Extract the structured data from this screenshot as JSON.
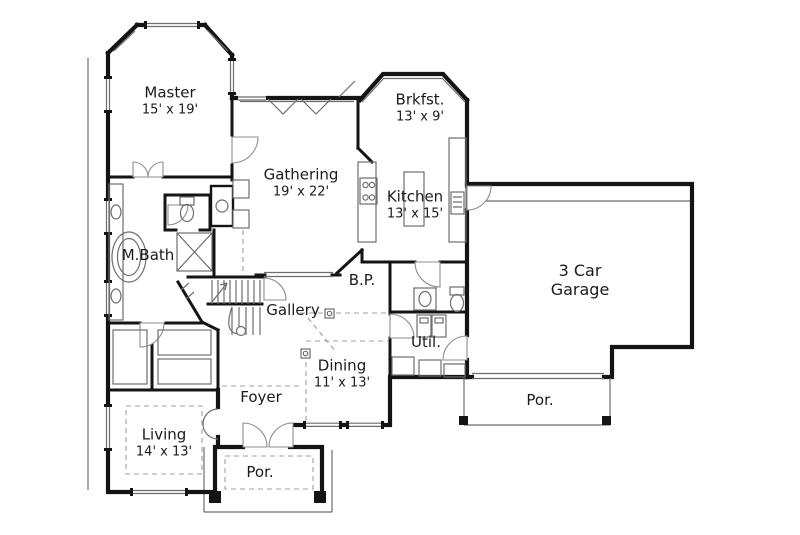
{
  "plan": {
    "type": "floor-plan",
    "rooms": [
      {
        "id": "master",
        "lines": [
          "Master",
          "15' x 19'"
        ]
      },
      {
        "id": "mbath",
        "lines": [
          "M.Bath"
        ]
      },
      {
        "id": "living",
        "lines": [
          "Living",
          "14' x 13'"
        ]
      },
      {
        "id": "gathering",
        "lines": [
          "Gathering",
          "19' x 22'"
        ]
      },
      {
        "id": "brkfst",
        "lines": [
          "Brkfst.",
          "13' x 9'"
        ]
      },
      {
        "id": "kitchen",
        "lines": [
          "Kitchen",
          "13' x 15'"
        ]
      },
      {
        "id": "garage",
        "lines": [
          "3 Car",
          "Garage"
        ]
      },
      {
        "id": "bp",
        "lines": [
          "B.P."
        ]
      },
      {
        "id": "gallery",
        "lines": [
          "Gallery"
        ]
      },
      {
        "id": "util",
        "lines": [
          "Util."
        ]
      },
      {
        "id": "dining",
        "lines": [
          "Dining",
          "11' x 13'"
        ]
      },
      {
        "id": "foyer",
        "lines": [
          "Foyer"
        ]
      },
      {
        "id": "porch_front",
        "lines": [
          "Por."
        ]
      },
      {
        "id": "porch_rear",
        "lines": [
          "Por."
        ]
      }
    ],
    "colors": {
      "wall": "#141414",
      "thin": "#6e6e6e",
      "dashc": "#9f9f9f",
      "door": "#8d8d8d",
      "text": "#1b1b1b",
      "bg": "#ffffff"
    }
  }
}
